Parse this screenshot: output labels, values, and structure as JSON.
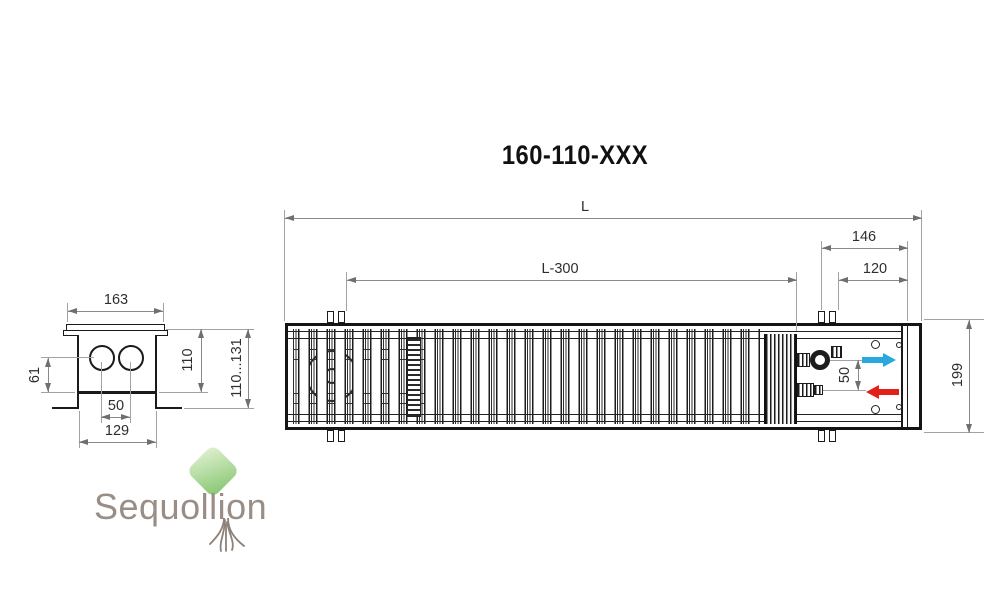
{
  "title": "160-110-XXX",
  "drawing": {
    "top_view": {
      "dim_length": "L",
      "dim_length_minus_300": "L-300",
      "dim_end_146": "146",
      "dim_end_120": "120",
      "dim_width_199": "199",
      "dim_pipe_spacing": "50"
    },
    "side_section": {
      "dim_top_width": "163",
      "dim_pipe_offset": "61",
      "dim_height": "110",
      "dim_height_range": "110...131",
      "dim_pipe_spacing": "50",
      "dim_bottom_width": "129"
    }
  },
  "flow_arrows": {
    "supply_color": "#29a8e0",
    "return_color": "#e32119"
  },
  "logo": {
    "text_part1": "Sequo",
    "text_part2": "llion",
    "text_color": "#9a8d85",
    "leaf_color_light": "#dcefcd",
    "leaf_color_dark": "#8fca7a"
  },
  "line_colors": {
    "drawing": "#1a1a1a",
    "dimension": "#8a8a8a",
    "dimension_text": "#2e2e2e"
  }
}
